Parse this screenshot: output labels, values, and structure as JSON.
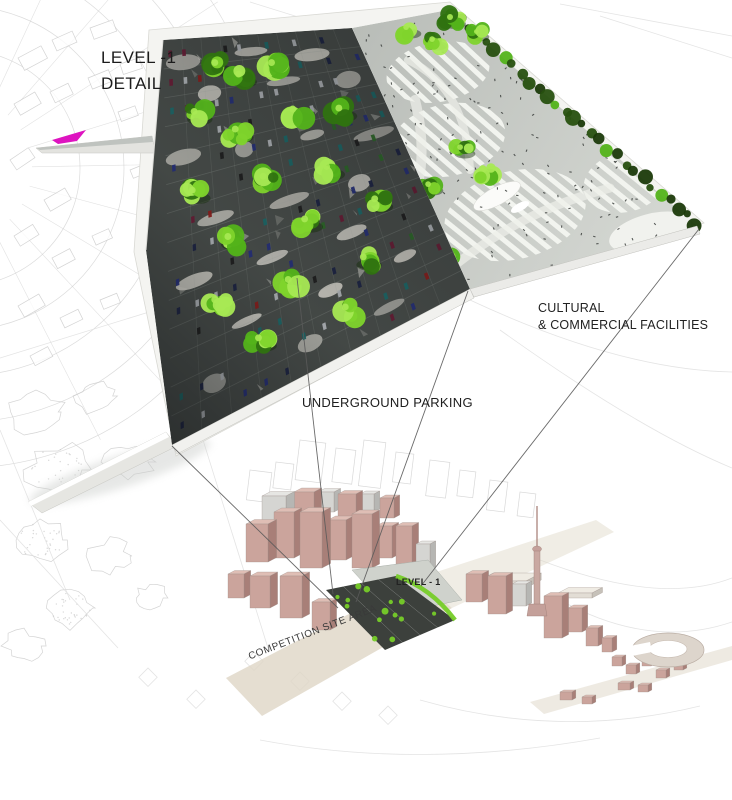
{
  "title": "LEVEL -1 DETAIL",
  "labels": {
    "level_detail": {
      "line1": "LEVEL -1",
      "line2": "DETAIL"
    },
    "facilities": {
      "line1": "CULTURAL",
      "line2": "& COMMERCIAL FACILITIES"
    },
    "underground_parking": "UNDERGROUND PARKING",
    "competition_site": "COMPETITION SITE AREA",
    "level_minus_one": "LEVEL - 1"
  },
  "colors": {
    "magenta": "#de14c0",
    "deck_base": "#4b504d",
    "deck_dark": "#23262a",
    "deck_grid": "#aab0aa",
    "skylight": "#ece9e0",
    "tree_dark": "#2f7210",
    "tree_mid": "#53b31a",
    "tree_light": "#7fd42c",
    "tree_hi": "#a8e954",
    "hedge": "#27500f",
    "hedge_dark": "#1b3a09",
    "plaza_base": "#b8bcb7",
    "plaza_light": "#d3d6d1",
    "plaza_stripe": "#f4f6f1",
    "rim": "#f4f4f1",
    "rim_edge": "#d9d9d4",
    "people": "#3b3e3c",
    "car_colors": [
      "#8f1f1c",
      "#27317e",
      "#1c6e6e",
      "#2e6e2a",
      "#1d2547",
      "#b9bec2",
      "#6e1d38",
      "#202020"
    ],
    "bldg_pink_front": "#cba49c",
    "bldg_pink_side": "#a87f78",
    "bldg_pink_top": "#dfbeb5",
    "bldg_gray_front": "#d5d5d2",
    "bldg_gray_side": "#b6b6b3",
    "bldg_gray_top": "#e6e6e3",
    "bldg_light_front": "#e2ddd5",
    "bldg_light_side": "#c6c1b9",
    "bldg_light_top": "#efebe3",
    "road": "#ded6c6",
    "projection_line": "#5a5a5a",
    "sketch": "#c9c9c9",
    "sketch_faint": "#dddddd",
    "mini_dark": "#3c403c",
    "mini_green": "#76cc28",
    "mini_plaza": "#cfd2cc"
  }
}
